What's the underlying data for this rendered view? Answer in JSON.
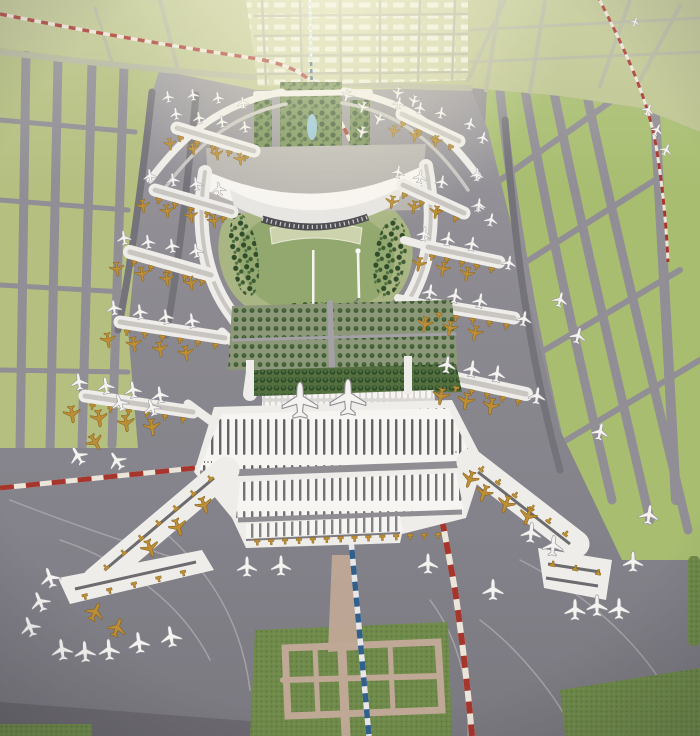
{
  "meta": {
    "description": "Aerial photograph of a large airport master-plan scale model: a white multi-pier terminal complex with a landscaped garden core, tree-lined median, parked white and gold model aircraft, gray aprons, green taxiway fields, a red-and-white railway line and a blue metro line"
  },
  "palette": {
    "apron_top": "#a29fa5",
    "apron_mid": "#8e8c92",
    "apron_low": "#84828a",
    "apron_dark": "#6c6a70",
    "green_top": "#bdc48f",
    "green_right": "#a8bd70",
    "green_left": "#b4bf80",
    "city_base": "#ced1a6",
    "city_block": "#eceee0",
    "hill_light": "#a9b583",
    "hill_dark": "#8aa366",
    "median_green": "#6f8a4f",
    "orchard_base": "#55703f",
    "park_base": "#8d9779",
    "turf_base": "#6f8a4a",
    "turf_dot_dark": "#5d773c",
    "turf_dot_light": "#7d9a57",
    "tree_dark": "#2f4d2b",
    "tree_mid": "#3d5c33",
    "tree_light": "#4e7040",
    "white_bldg": "#efede9",
    "white_bright": "#f7f5f2",
    "roof_line": "#c9c6c2",
    "rib_dark": "#4b4a50",
    "road_green": "#b4b69e",
    "road_gray": "#918e95",
    "lane_dark": "#75737a",
    "lane_light": "#a3a0a6",
    "road_pink": "#c0a896",
    "gold": "#bd8e35",
    "gold_dark": "#7e5e1d",
    "plane_white": "#f4f3f0",
    "red_line": "#a6352c",
    "line_white": "#ece5da",
    "blue_line": "#31608c",
    "blue_light": "#cfe0ea",
    "lake": "#8fc0d8",
    "glow": "#fffbe0"
  },
  "scene": {
    "piers": [
      [
        177,
        128,
        254,
        151,
        13,
        5,
        1
      ],
      [
        155,
        190,
        232,
        212,
        13,
        5,
        1
      ],
      [
        130,
        252,
        211,
        275,
        14,
        5,
        1
      ],
      [
        120,
        322,
        225,
        338,
        13,
        6,
        1
      ],
      [
        85,
        396,
        193,
        412,
        13,
        6,
        1
      ],
      [
        402,
        114,
        459,
        141,
        13,
        4,
        1
      ],
      [
        403,
        185,
        464,
        213,
        13,
        4,
        1
      ],
      [
        428,
        247,
        499,
        262,
        13,
        5,
        1
      ],
      [
        434,
        305,
        514,
        318,
        13,
        5,
        1
      ],
      [
        452,
        378,
        526,
        394,
        14,
        5,
        1
      ]
    ],
    "stems": [
      [
        222,
        332,
        254,
        364,
        9
      ],
      [
        188,
        404,
        237,
        440,
        9
      ],
      [
        404,
        240,
        447,
        252,
        8
      ],
      [
        398,
        298,
        452,
        309,
        8
      ],
      [
        418,
        362,
        470,
        382,
        9
      ]
    ],
    "bridge_rows": [
      [
        240,
        540,
        455,
        532,
        14,
        1
      ],
      [
        222,
        472,
        98,
        578,
        7,
        1
      ],
      [
        472,
        465,
        572,
        542,
        6,
        -1
      ],
      [
        75,
        596,
        192,
        568,
        5,
        1
      ],
      [
        548,
        566,
        602,
        576,
        3,
        -1
      ]
    ],
    "aircraft": [
      [
        168,
        97,
        -8,
        0.7,
        "w"
      ],
      [
        193,
        95,
        -8,
        0.7,
        "w"
      ],
      [
        218,
        98,
        -8,
        0.7,
        "w"
      ],
      [
        243,
        103,
        -8,
        0.7,
        "w"
      ],
      [
        347,
        96,
        200,
        0.7,
        "w"
      ],
      [
        363,
        107,
        200,
        0.7,
        "w"
      ],
      [
        379,
        119,
        205,
        0.7,
        "w"
      ],
      [
        362,
        132,
        195,
        0.7,
        "w"
      ],
      [
        398,
        93,
        190,
        0.7,
        "w"
      ],
      [
        414,
        101,
        195,
        0.7,
        "w"
      ],
      [
        176,
        114,
        -8,
        0.72,
        "w"
      ],
      [
        199,
        118,
        -8,
        0.72,
        "w"
      ],
      [
        222,
        122,
        -8,
        0.72,
        "w"
      ],
      [
        245,
        127,
        -8,
        0.72,
        "w"
      ],
      [
        170,
        144,
        172,
        0.72,
        "g"
      ],
      [
        193,
        149,
        172,
        0.72,
        "g"
      ],
      [
        217,
        154,
        172,
        0.72,
        "g"
      ],
      [
        240,
        159,
        172,
        0.72,
        "g"
      ],
      [
        150,
        176,
        -8,
        0.8,
        "w"
      ],
      [
        173,
        180,
        -8,
        0.8,
        "w"
      ],
      [
        196,
        184,
        -8,
        0.8,
        "w"
      ],
      [
        219,
        189,
        -8,
        0.8,
        "w"
      ],
      [
        143,
        206,
        172,
        0.8,
        "g"
      ],
      [
        167,
        211,
        172,
        0.8,
        "g"
      ],
      [
        191,
        216,
        172,
        0.8,
        "g"
      ],
      [
        214,
        221,
        172,
        0.8,
        "g"
      ],
      [
        124,
        238,
        -8,
        0.85,
        "w"
      ],
      [
        148,
        242,
        -8,
        0.85,
        "w"
      ],
      [
        172,
        246,
        -8,
        0.85,
        "w"
      ],
      [
        196,
        251,
        -8,
        0.85,
        "w"
      ],
      [
        117,
        269,
        172,
        0.85,
        "g"
      ],
      [
        142,
        274,
        172,
        0.85,
        "g"
      ],
      [
        167,
        279,
        172,
        0.85,
        "g"
      ],
      [
        191,
        283,
        172,
        0.85,
        "g"
      ],
      [
        114,
        308,
        -8,
        0.9,
        "w"
      ],
      [
        140,
        312,
        -8,
        0.9,
        "w"
      ],
      [
        166,
        317,
        -8,
        0.9,
        "w"
      ],
      [
        192,
        321,
        -8,
        0.9,
        "w"
      ],
      [
        108,
        340,
        172,
        0.9,
        "g"
      ],
      [
        134,
        344,
        172,
        0.9,
        "g"
      ],
      [
        160,
        349,
        172,
        0.9,
        "g"
      ],
      [
        186,
        353,
        172,
        0.9,
        "g"
      ],
      [
        79,
        382,
        -8,
        1,
        "w"
      ],
      [
        106,
        386,
        -8,
        1,
        "w"
      ],
      [
        133,
        390,
        -8,
        1,
        "w"
      ],
      [
        160,
        395,
        -8,
        1,
        "w"
      ],
      [
        72,
        414,
        172,
        1,
        "g"
      ],
      [
        99,
        418,
        172,
        1,
        "g"
      ],
      [
        126,
        423,
        172,
        1,
        "g"
      ],
      [
        152,
        427,
        172,
        1,
        "g"
      ],
      [
        120,
        403,
        -18,
        1,
        "w"
      ],
      [
        152,
        408,
        -18,
        1,
        "w"
      ],
      [
        78,
        456,
        -30,
        1.12,
        "w"
      ],
      [
        117,
        461,
        -33,
        1.12,
        "w"
      ],
      [
        95,
        442,
        150,
        1,
        "g"
      ],
      [
        399,
        103,
        10,
        0.7,
        "w"
      ],
      [
        420,
        108,
        10,
        0.7,
        "w"
      ],
      [
        441,
        113,
        10,
        0.7,
        "w"
      ],
      [
        394,
        131,
        190,
        0.7,
        "g"
      ],
      [
        415,
        136,
        190,
        0.7,
        "g"
      ],
      [
        436,
        141,
        190,
        0.7,
        "g"
      ],
      [
        470,
        124,
        15,
        0.72,
        "w"
      ],
      [
        483,
        138,
        15,
        0.72,
        "w"
      ],
      [
        398,
        172,
        10,
        0.78,
        "w"
      ],
      [
        420,
        177,
        10,
        0.78,
        "w"
      ],
      [
        442,
        182,
        10,
        0.78,
        "w"
      ],
      [
        392,
        202,
        190,
        0.78,
        "g"
      ],
      [
        414,
        207,
        190,
        0.78,
        "g"
      ],
      [
        436,
        212,
        190,
        0.78,
        "g"
      ],
      [
        478,
        206,
        12,
        0.8,
        "w"
      ],
      [
        491,
        220,
        12,
        0.8,
        "w"
      ],
      [
        424,
        234,
        10,
        0.85,
        "w"
      ],
      [
        448,
        239,
        10,
        0.85,
        "w"
      ],
      [
        472,
        244,
        10,
        0.85,
        "w"
      ],
      [
        419,
        264,
        190,
        0.85,
        "g"
      ],
      [
        443,
        269,
        190,
        0.85,
        "g"
      ],
      [
        467,
        274,
        190,
        0.85,
        "g"
      ],
      [
        509,
        263,
        10,
        0.85,
        "w"
      ],
      [
        430,
        292,
        10,
        0.9,
        "w"
      ],
      [
        455,
        296,
        10,
        0.9,
        "w"
      ],
      [
        480,
        301,
        10,
        0.9,
        "w"
      ],
      [
        425,
        324,
        190,
        0.9,
        "g"
      ],
      [
        450,
        328,
        190,
        0.9,
        "g"
      ],
      [
        475,
        333,
        190,
        0.9,
        "g"
      ],
      [
        524,
        319,
        10,
        0.9,
        "w"
      ],
      [
        447,
        365,
        8,
        1,
        "w"
      ],
      [
        472,
        369,
        8,
        1,
        "w"
      ],
      [
        497,
        374,
        8,
        1,
        "w"
      ],
      [
        441,
        396,
        190,
        1,
        "g"
      ],
      [
        466,
        401,
        190,
        1,
        "g"
      ],
      [
        491,
        406,
        190,
        1,
        "g"
      ],
      [
        537,
        396,
        8,
        1,
        "w"
      ],
      [
        648,
        110,
        25,
        0.7,
        "w"
      ],
      [
        657,
        130,
        25,
        0.7,
        "w"
      ],
      [
        666,
        150,
        25,
        0.72,
        "w"
      ],
      [
        477,
        175,
        5,
        0.78,
        "w"
      ],
      [
        479,
        205,
        5,
        0.8,
        "w"
      ],
      [
        560,
        300,
        15,
        0.9,
        "w"
      ],
      [
        578,
        336,
        15,
        0.95,
        "w"
      ],
      [
        635,
        22,
        20,
        0.55,
        "w"
      ],
      [
        600,
        432,
        12,
        1,
        "w"
      ],
      [
        300,
        401,
        0,
        2.1,
        "w"
      ],
      [
        348,
        398,
        0,
        2.1,
        "w"
      ],
      [
        150,
        548,
        160,
        1.05,
        "g"
      ],
      [
        178,
        527,
        160,
        1.05,
        "g"
      ],
      [
        204,
        505,
        160,
        1,
        "g"
      ],
      [
        117,
        628,
        20,
        1.1,
        "g"
      ],
      [
        95,
        612,
        25,
        1.1,
        "g"
      ],
      [
        50,
        578,
        -18,
        1.2,
        "w"
      ],
      [
        40,
        602,
        -22,
        1.2,
        "w"
      ],
      [
        30,
        627,
        -20,
        1.2,
        "w"
      ],
      [
        62,
        650,
        -8,
        1.25,
        "w"
      ],
      [
        85,
        652,
        -4,
        1.25,
        "w"
      ],
      [
        109,
        650,
        -4,
        1.25,
        "w"
      ],
      [
        139,
        643,
        -8,
        1.25,
        "w"
      ],
      [
        171,
        637,
        -10,
        1.25,
        "w"
      ],
      [
        247,
        567,
        0,
        1.2,
        "w"
      ],
      [
        281,
        566,
        0,
        1.2,
        "w"
      ],
      [
        428,
        564,
        0,
        1.2,
        "w"
      ],
      [
        470,
        479,
        200,
        1,
        "g"
      ],
      [
        484,
        493,
        200,
        1,
        "g"
      ],
      [
        506,
        504,
        200,
        1.05,
        "g"
      ],
      [
        528,
        516,
        200,
        1.05,
        "g"
      ],
      [
        531,
        533,
        5,
        1.2,
        "w"
      ],
      [
        553,
        546,
        5,
        1.2,
        "w"
      ],
      [
        493,
        590,
        0,
        1.25,
        "w"
      ],
      [
        575,
        610,
        0,
        1.25,
        "w"
      ],
      [
        597,
        606,
        0,
        1.25,
        "w"
      ],
      [
        619,
        609,
        0,
        1.25,
        "w"
      ],
      [
        633,
        562,
        0,
        1.2,
        "w"
      ],
      [
        649,
        515,
        8,
        1.15,
        "w"
      ]
    ]
  }
}
